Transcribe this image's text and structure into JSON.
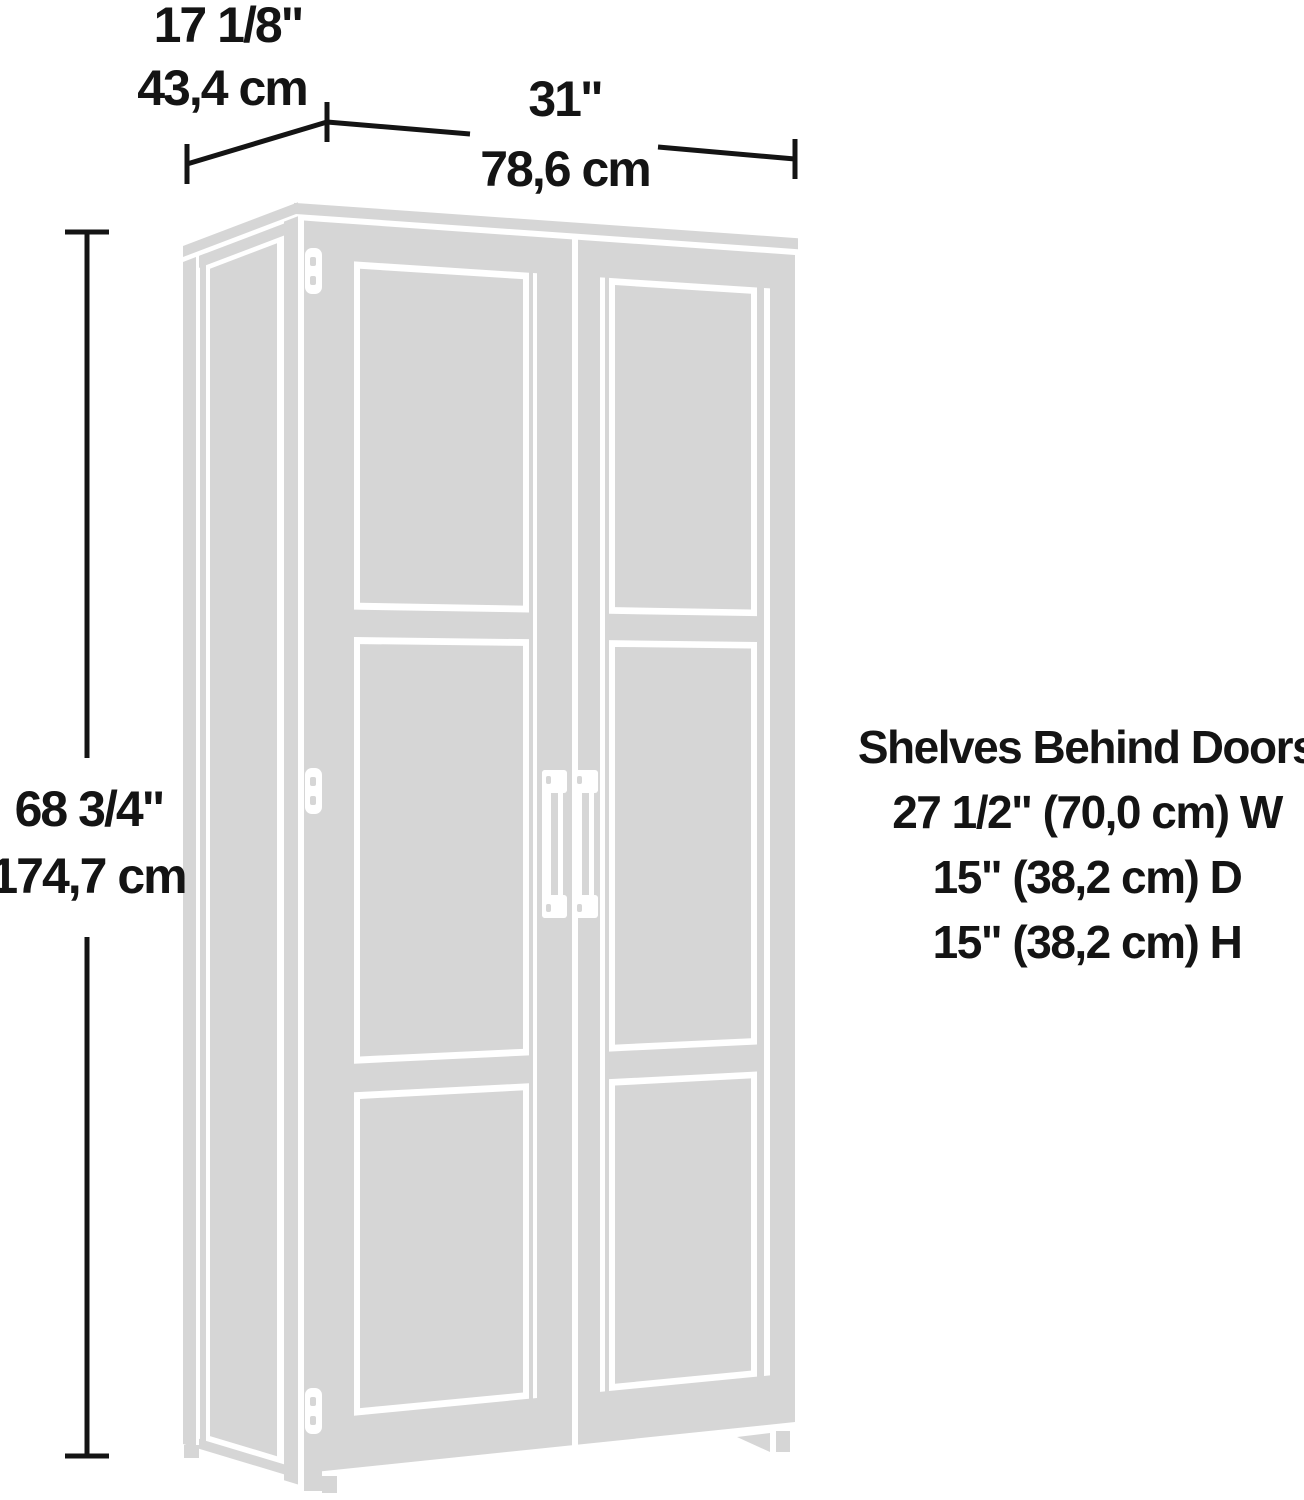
{
  "figure": {
    "type": "product-dimension-diagram",
    "product": "two-door storage cabinet line drawing",
    "colors": {
      "drawing_gray": "#d6d6d6",
      "line_black": "#141414",
      "background": "#ffffff"
    },
    "dimensions": {
      "depth": {
        "inches": "17 1/8\"",
        "cm": "43,4 cm"
      },
      "width": {
        "inches": "31\"",
        "cm": "78,6 cm"
      },
      "height": {
        "inches": "68 3/4\"",
        "cm": "174,7 cm"
      }
    },
    "shelf_note": {
      "title": "Shelves Behind Doors",
      "lines": [
        "27 1/2\" (70,0 cm) W",
        "15\" (38,2 cm) D",
        "15\" (38,2 cm) H"
      ]
    }
  }
}
